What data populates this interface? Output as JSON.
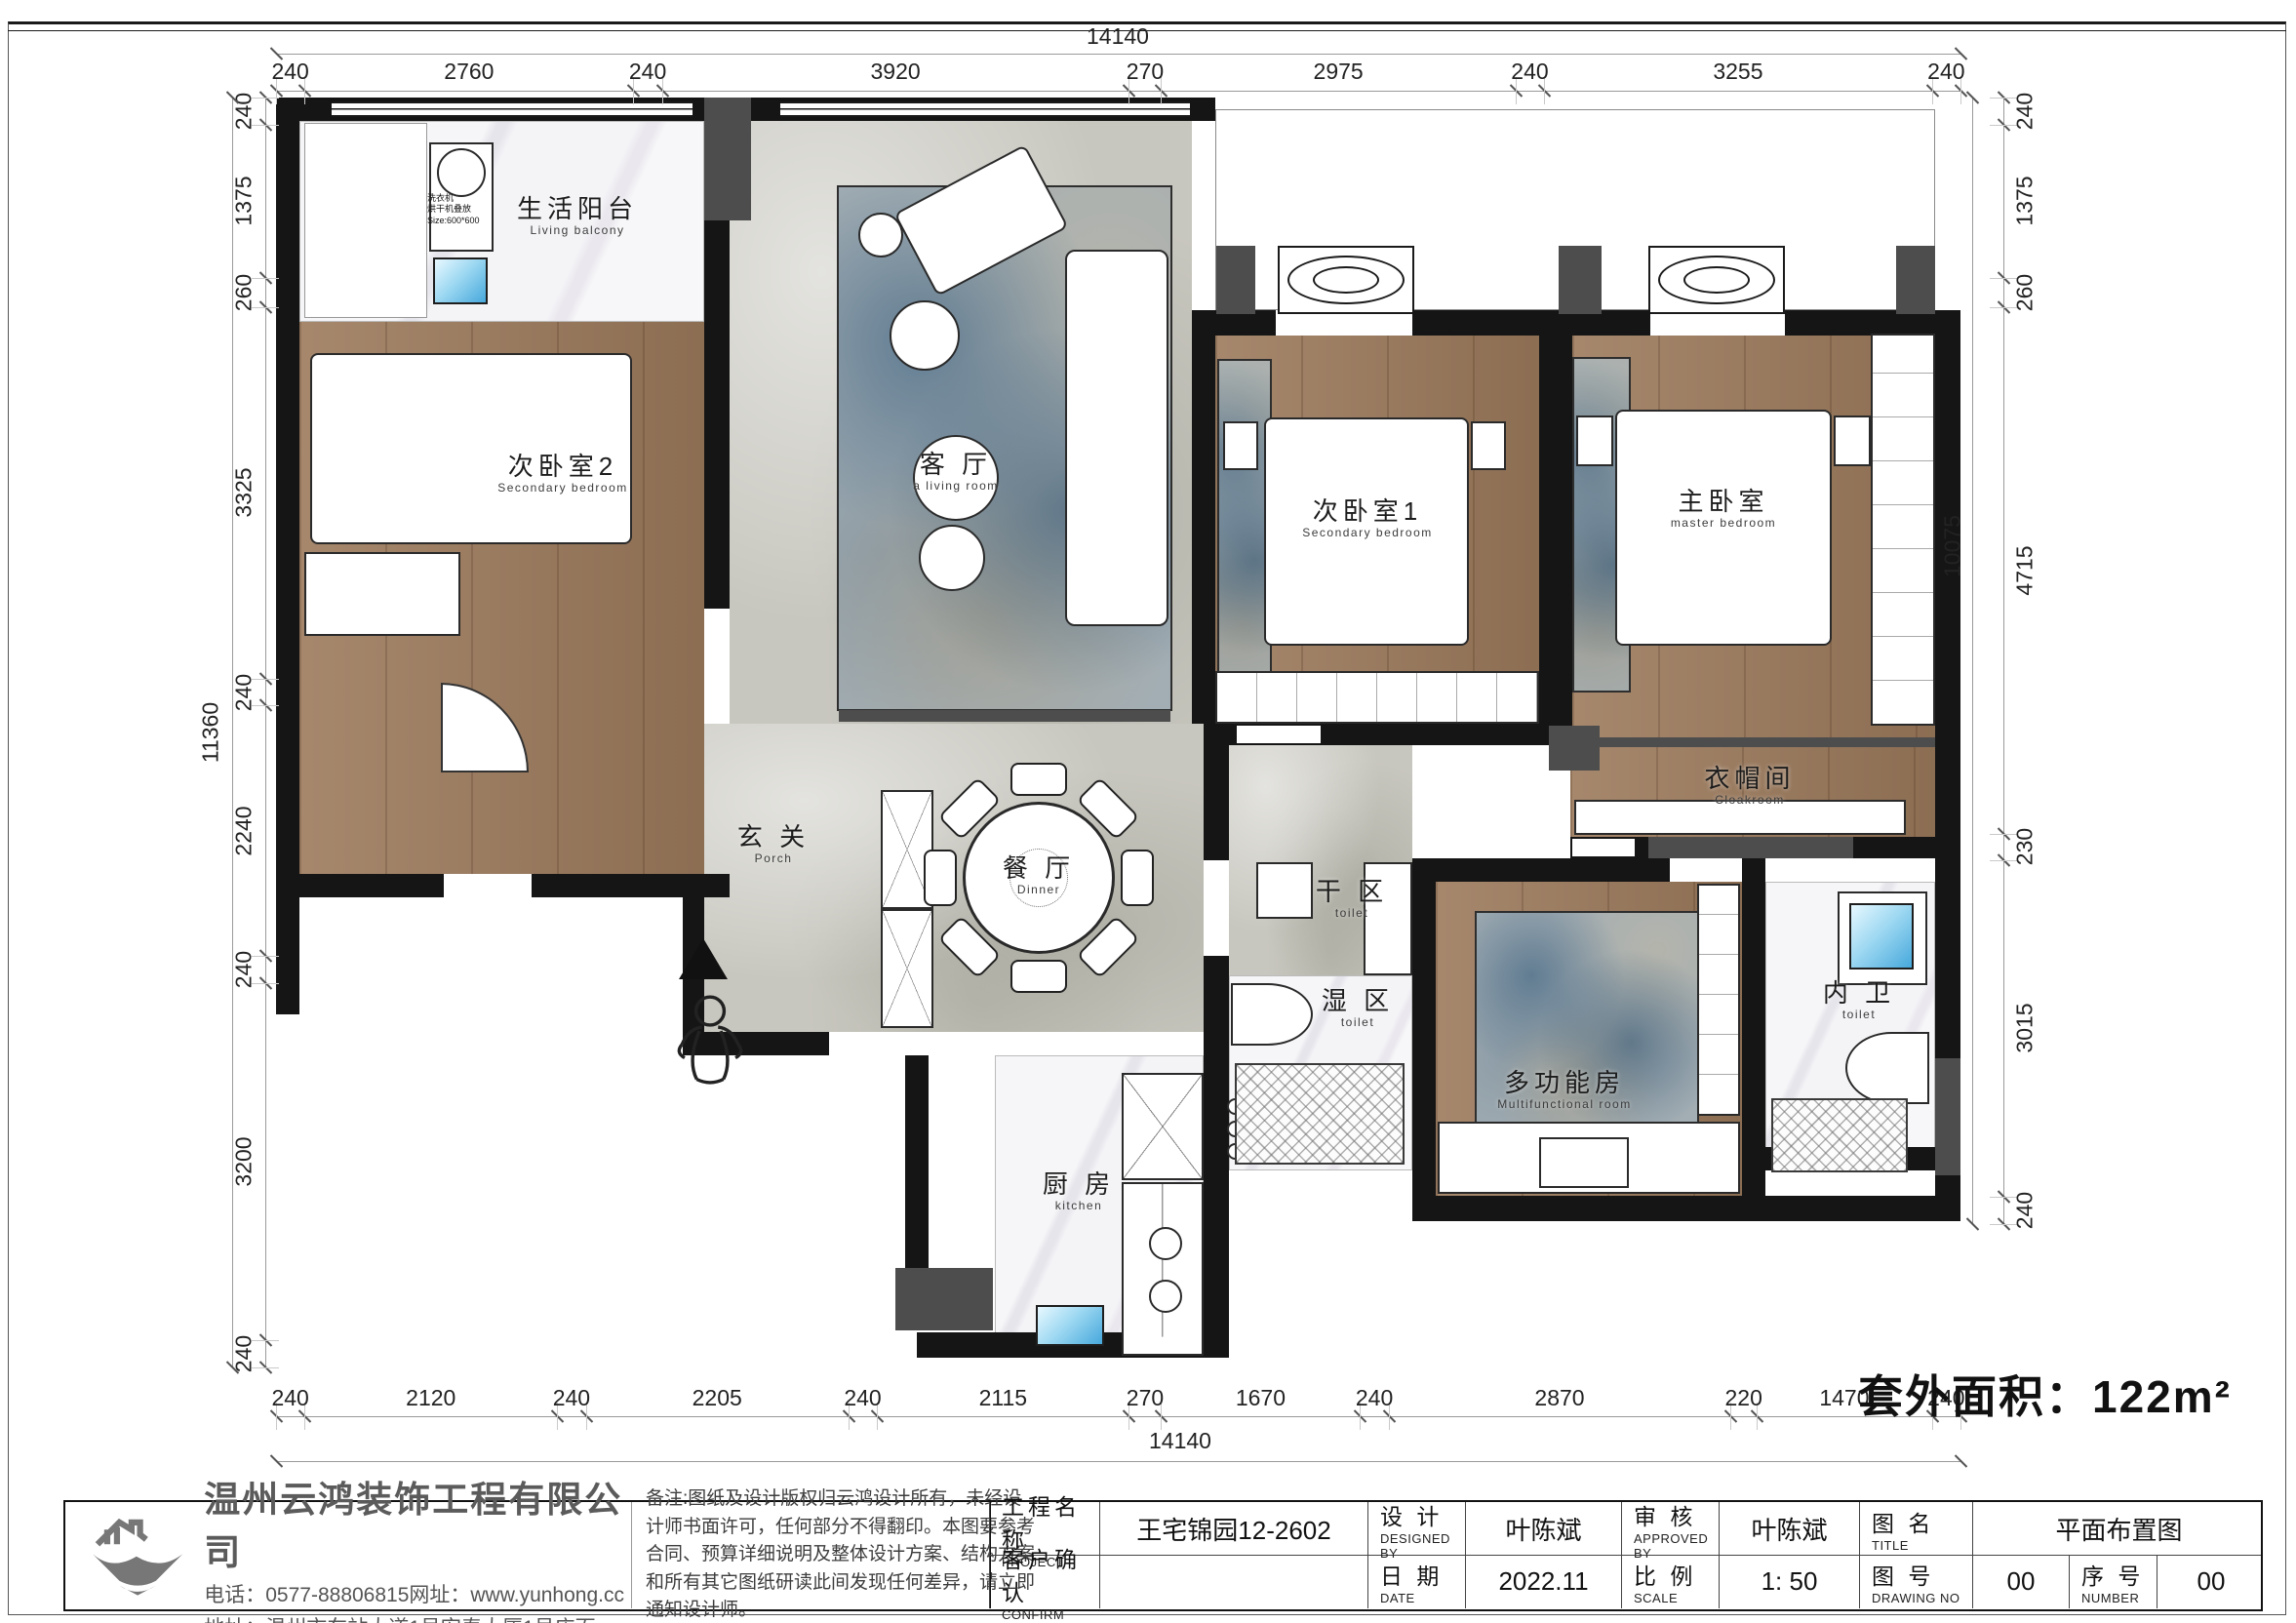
{
  "sheet": {
    "area_note": "套外面积：122m²"
  },
  "dimensions": {
    "top": {
      "total": "14140",
      "segments": [
        "240",
        "2760",
        "240",
        "3920",
        "270",
        "2975",
        "240",
        "3255",
        "240"
      ]
    },
    "bottom": {
      "total": "14140",
      "segments": [
        "240",
        "2120",
        "240",
        "2205",
        "240",
        "2115",
        "270",
        "1670",
        "240",
        "2870",
        "220",
        "1470",
        "240"
      ]
    },
    "left": {
      "total": "11360",
      "segments": [
        "240",
        "1375",
        "260",
        "3325",
        "240",
        "2240",
        "240",
        "3200",
        "240"
      ]
    },
    "right": {
      "total": "10075",
      "segments": [
        "240",
        "1375",
        "260",
        "4715",
        "230",
        "3015",
        "240"
      ]
    }
  },
  "rooms": [
    {
      "id": "balcony",
      "name": "生活阳台",
      "en": "Living balcony"
    },
    {
      "id": "bedroom2",
      "name": "次卧室2",
      "en": "Secondary bedroom"
    },
    {
      "id": "living",
      "name": "客 厅",
      "en": "a living room"
    },
    {
      "id": "bedroom1",
      "name": "次卧室1",
      "en": "Secondary bedroom"
    },
    {
      "id": "master",
      "name": "主卧室",
      "en": "master bedroom"
    },
    {
      "id": "cloakroom",
      "name": "衣帽间",
      "en": "Cloakroom"
    },
    {
      "id": "hall",
      "name": "玄 关",
      "en": "Porch"
    },
    {
      "id": "dining",
      "name": "餐 厅",
      "en": "Dinner"
    },
    {
      "id": "dry",
      "name": "干 区",
      "en": "toilet"
    },
    {
      "id": "wet",
      "name": "湿 区",
      "en": "toilet"
    },
    {
      "id": "multi",
      "name": "多功能房",
      "en": "Multifunctional room"
    },
    {
      "id": "toilet2",
      "name": "内 卫",
      "en": "toilet"
    },
    {
      "id": "kitchen",
      "name": "厨 房",
      "en": "kitchen"
    }
  ],
  "annotations": {
    "washer": "洗衣机\n烘干机叠放\nSize:600*600"
  },
  "titleblock": {
    "company": {
      "name": "温州云鸿装饰工程有限公司",
      "phone": "电话：0577-88806815网址：www.yunhong.cc",
      "address": "地址：温州市车站大道1号宏泰大厦1号店面"
    },
    "notes": "备注:图纸及设计版权归云鸿设计所有，未经设计师书面许可，任何部分不得翻印。本图要参考合同、预算详细说明及整体设计方案、结构方案和所有其它图纸研读此间发现任何差异，请立即通知设计师。",
    "fields": {
      "project": {
        "label": "工程名称",
        "sub": "PROJECT",
        "value": "王宅锦园12-2602"
      },
      "confirm": {
        "label": "客户确认",
        "sub": "CONFIRM",
        "value": ""
      },
      "design": {
        "label": "设 计",
        "sub": "DESIGNED BY",
        "value": "叶陈斌"
      },
      "date": {
        "label": "日 期",
        "sub": "DATE",
        "value": "2022.11"
      },
      "approve": {
        "label": "审 核",
        "sub": "APPROVED BY",
        "value": "叶陈斌"
      },
      "scale": {
        "label": "比 例",
        "sub": "SCALE",
        "value": "1: 50"
      },
      "title": {
        "label": "图 名",
        "sub": "TITLE",
        "value": "平面布置图"
      },
      "drawing_no": {
        "label": "图 号",
        "sub": "DRAWING NO",
        "value": "00"
      },
      "number": {
        "label": "序 号",
        "sub": "NUMBER",
        "value": "00"
      }
    }
  }
}
